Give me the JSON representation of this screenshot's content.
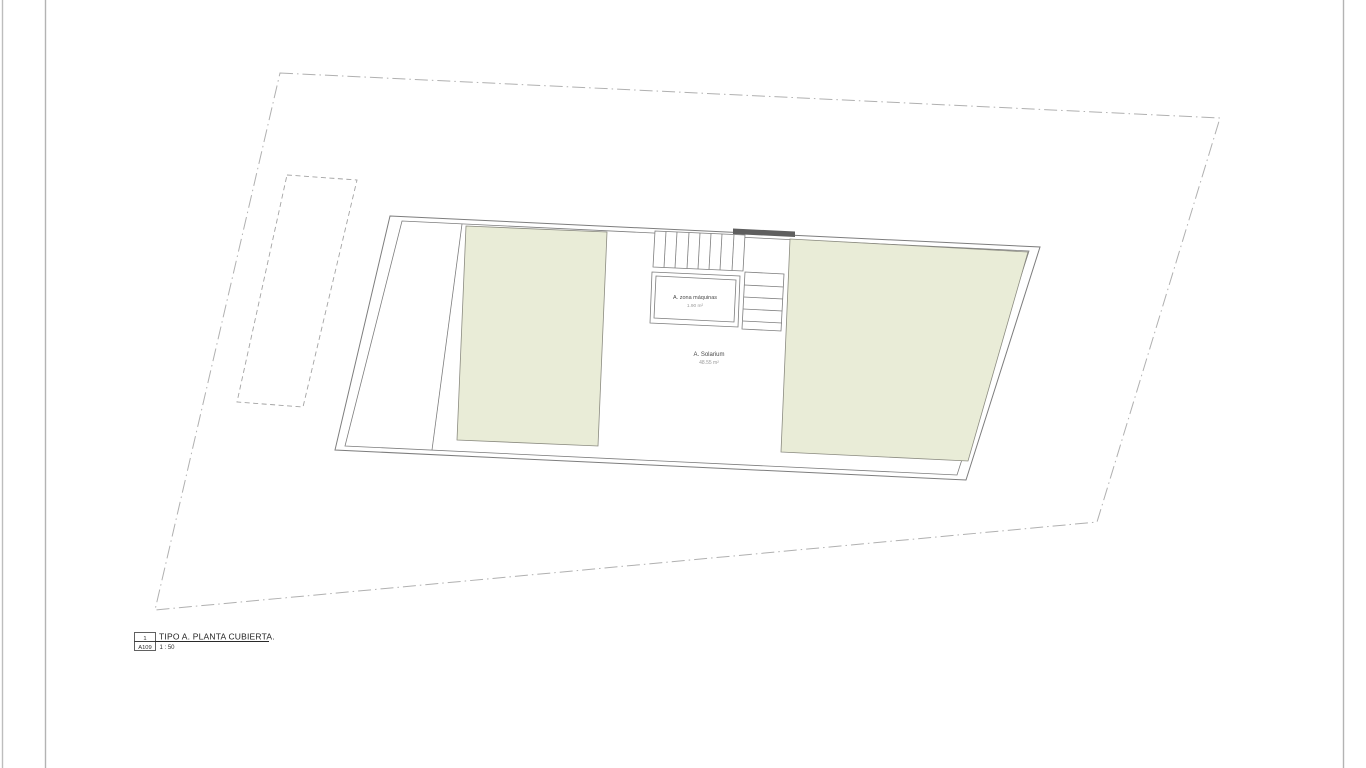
{
  "sheet": {
    "plan_labels": {
      "machine_room": "A. zona máquinas",
      "machine_room_area": "1.90 m²",
      "solarium": "A. Solarium",
      "solarium_area": "48.55 m²"
    },
    "title_block": {
      "detail_number": "1",
      "sheet_number": "A109",
      "title": "TIPO A. PLANTA CUBIERTA.",
      "scale": "1 : 50"
    },
    "colors": {
      "roof_terrace_fill": "#e9ecd7",
      "stair_wall_fill": "#5f5f5f",
      "building_outline": "#7d7d7d",
      "site_boundary": "#b0b0b0"
    }
  }
}
